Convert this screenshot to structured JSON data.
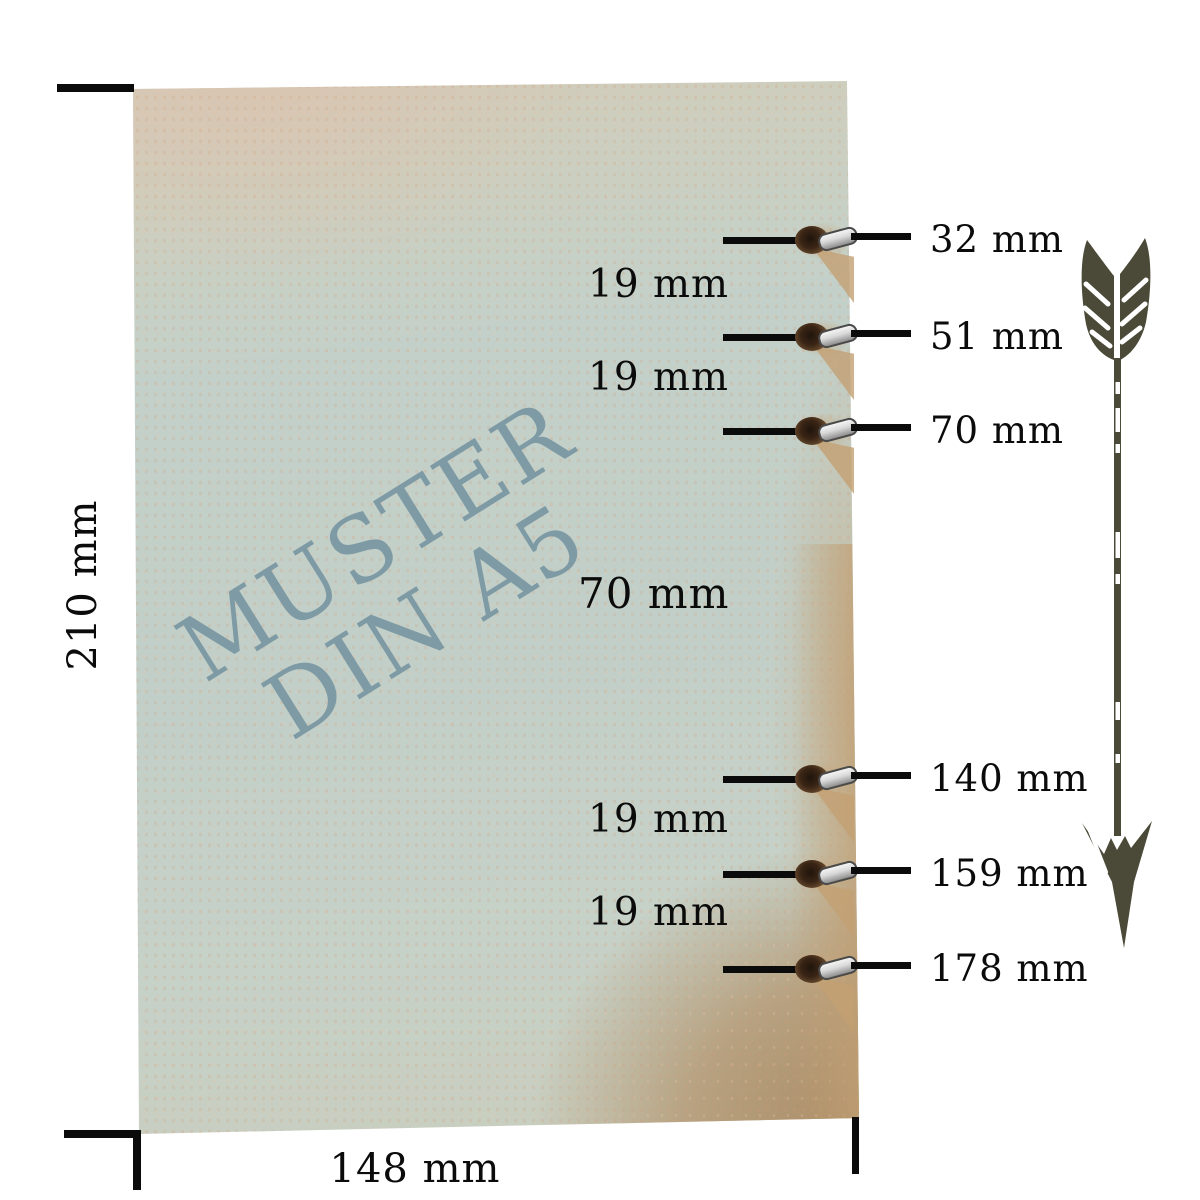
{
  "watermark": {
    "line1": "MUSTER",
    "line2": "DIN A5"
  },
  "sheet": {
    "height_label": "210 mm",
    "width_label": "148 mm"
  },
  "holes": [
    "32 mm",
    "51 mm",
    "70 mm",
    "140 mm",
    "159 mm",
    "178 mm"
  ],
  "spacings": [
    "19 mm",
    "19 mm",
    "70 mm",
    "19 mm",
    "19 mm"
  ],
  "icons": {
    "arrow": "feathered-down-arrow-icon"
  },
  "colors": {
    "paper-green": "#c2cfc8",
    "paper-beige": "#d4cab7",
    "paper-tan": "#b29677",
    "edge-tan": "#c8a77e",
    "watermark-blue": "#7e9aa4",
    "ink-black": "#0b0b0b",
    "arrow-olive": "#4b4a38",
    "hole-brown": "#5c4128",
    "ring-silver": "#d9d9d9"
  }
}
